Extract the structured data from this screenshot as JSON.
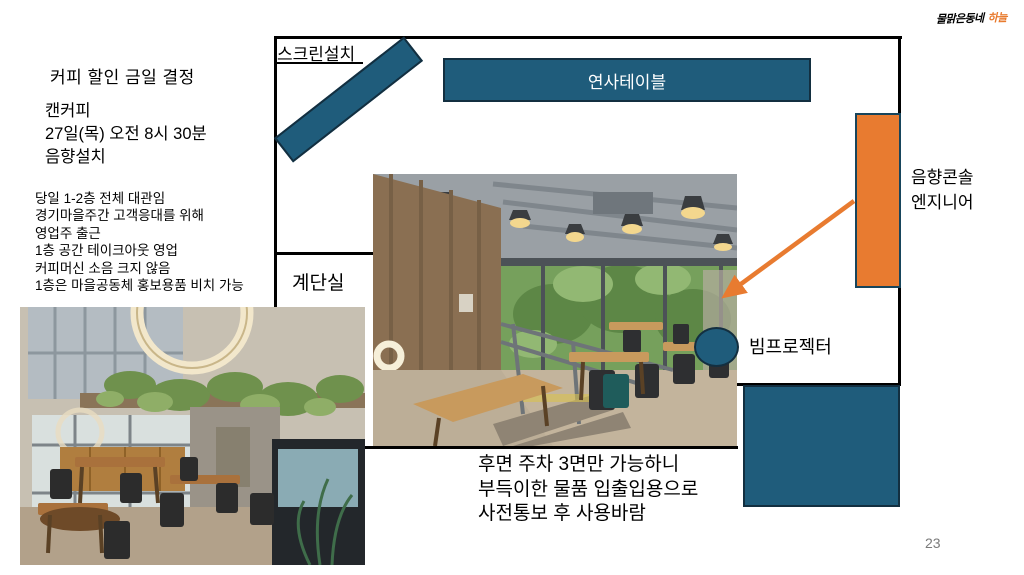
{
  "page": {
    "number": "23",
    "background": "#ffffff"
  },
  "logo": {
    "main": "물맑은동네",
    "accent": "하늘",
    "accent_color": "#e8792c"
  },
  "left_panel": {
    "title": "커피 할인 금일 결정",
    "schedule": [
      "캔커피",
      "27일(목) 오전 8시 30분",
      "음향설치"
    ],
    "notes": [
      "당일 1-2층 전체 대관임",
      "경기마을주간 고객응대를 위해",
      "영업주 출근",
      "1층 공간 테이크아웃 영업",
      "커피머신 소음 크지 않음",
      "1층은 마을공동체 홍보용품 비치 가능"
    ]
  },
  "floor_plan": {
    "screen_label": "스크린설치",
    "speaker_table_label": "연사테이블",
    "stairwell_label": "계단실",
    "console_label_line1": "음향콘솔",
    "console_label_line2": "엔지니어",
    "projector_label": "빔프로젝터",
    "colors": {
      "shape_fill": "#1f5c7b",
      "shape_border": "#132f40",
      "console_fill": "#e87b30",
      "arrow": "#e87b30",
      "wall": "#000000"
    }
  },
  "bottom_note": {
    "line1": "후면 주차 3면만 가능하니",
    "line2": "부득이한 물품 입출입용으로",
    "line3": "사전통보 후 사용바람"
  }
}
